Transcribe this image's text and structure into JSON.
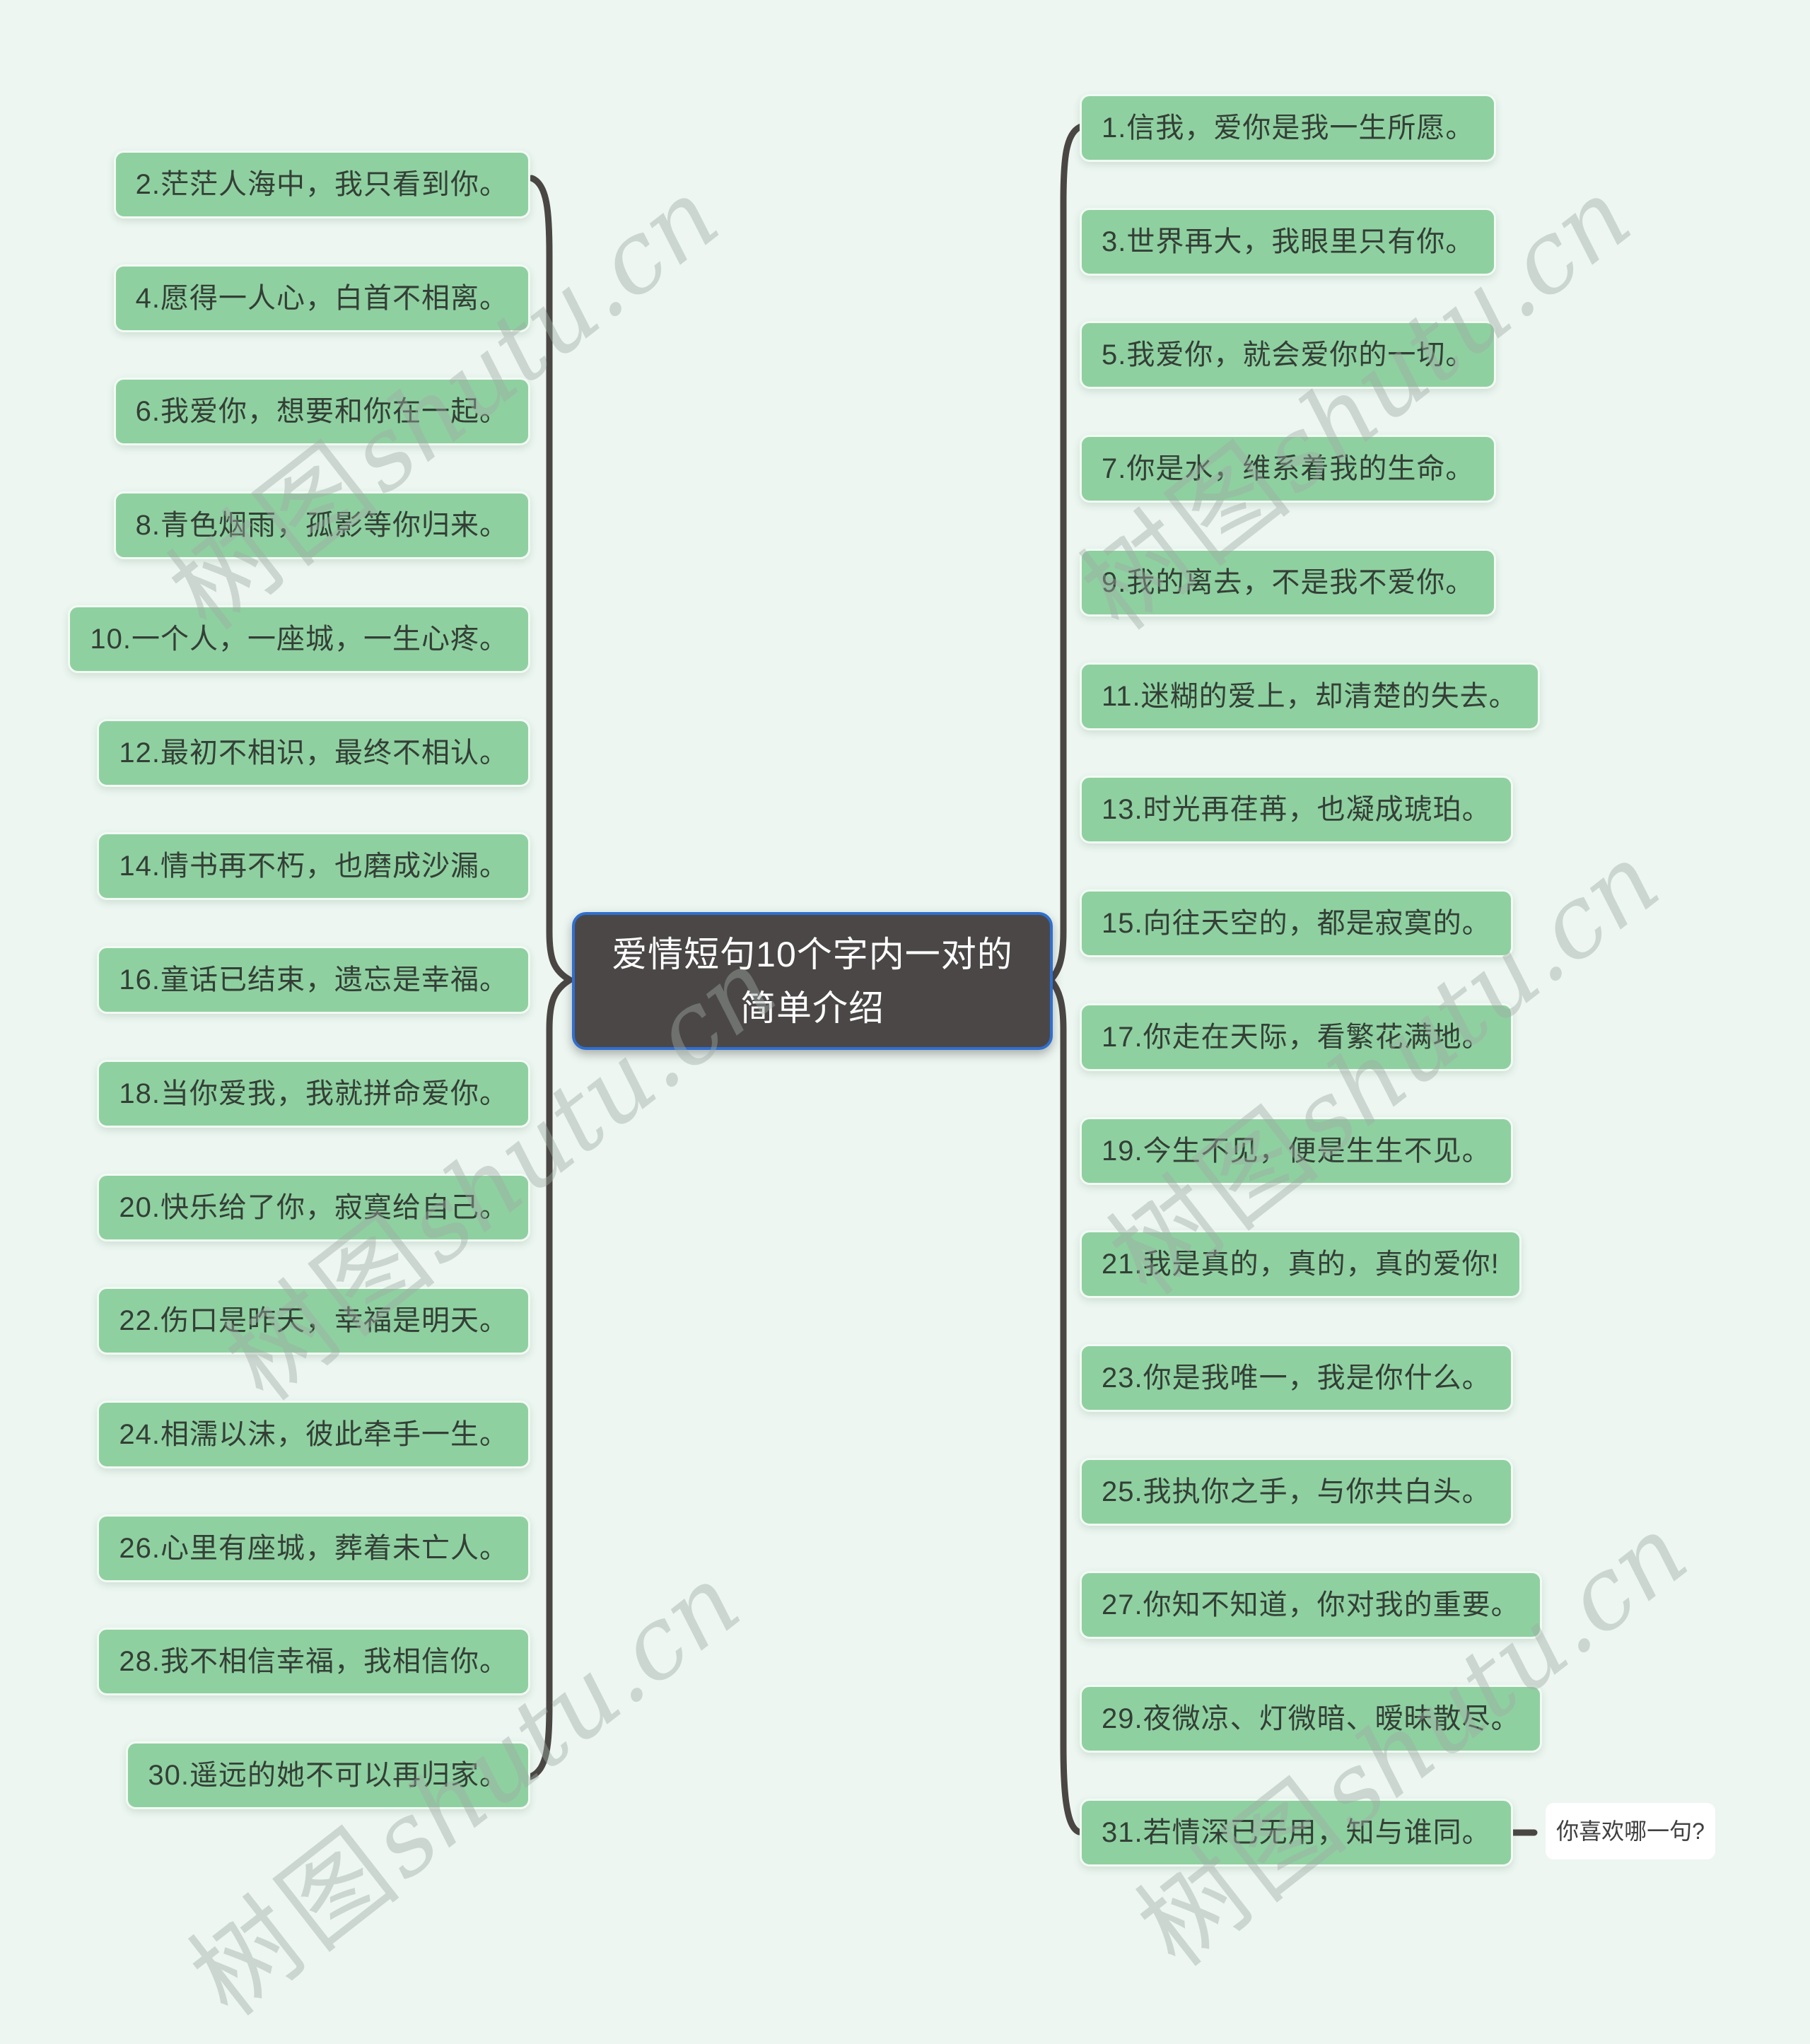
{
  "page": {
    "background_color": "#EDF6F1"
  },
  "center_node": {
    "line1": "爱情短句10个字内一对的",
    "line2": "简单介绍",
    "bg_color": "#4B4747",
    "border_color": "#2F6FD0",
    "text_color": "#FFFFFF"
  },
  "left_items": [
    "2.茫茫人海中，我只看到你。",
    "4.愿得一人心，白首不相离。",
    "6.我爱你，想要和你在一起。",
    "8.青色烟雨，孤影等你归来。",
    "10.一个人，一座城，一生心疼。",
    "12.最初不相识，最终不相认。",
    "14.情书再不朽，也磨成沙漏。",
    "16.童话已结束，遗忘是幸福。",
    "18.当你爱我，我就拼命爱你。",
    "20.快乐给了你，寂寞给自己。",
    "22.伤口是昨天，幸福是明天。",
    "24.相濡以沫，彼此牵手一生。",
    "26.心里有座城，葬着未亡人。",
    "28.我不相信幸福，我相信你。",
    "30.遥远的她不可以再归家。"
  ],
  "right_items": [
    "1.信我，爱你是我一生所愿。",
    "3.世界再大，我眼里只有你。",
    "5.我爱你，就会爱你的一切。",
    "7.你是水，维系着我的生命。",
    "9.我的离去，不是我不爱你。",
    "11.迷糊的爱上，却清楚的失去。",
    "13.时光再荏苒，也凝成琥珀。",
    "15.向往天空的，都是寂寞的。",
    "17.你走在天际，看繁花满地。",
    "19.今生不见，便是生生不见。",
    "21.我是真的，真的，真的爱你!",
    "23.你是我唯一，我是你什么。",
    "25.我执你之手，与你共白头。",
    "27.你知不知道，你对我的重要。",
    "29.夜微凉、灯微暗、暧昧散尽。",
    "31.若情深已无用，知与谁同。"
  ],
  "annotation": {
    "label": "你喜欢哪一句?"
  },
  "watermark": {
    "text_cn": "树图",
    "text_latin": "shutu.cn",
    "color": "#9FACA5"
  },
  "colors": {
    "quote_box_fill": "#8FD0A0",
    "quote_box_text": "#333F36",
    "brace_stroke": "#4A4644",
    "background": "#EDF6F1"
  }
}
